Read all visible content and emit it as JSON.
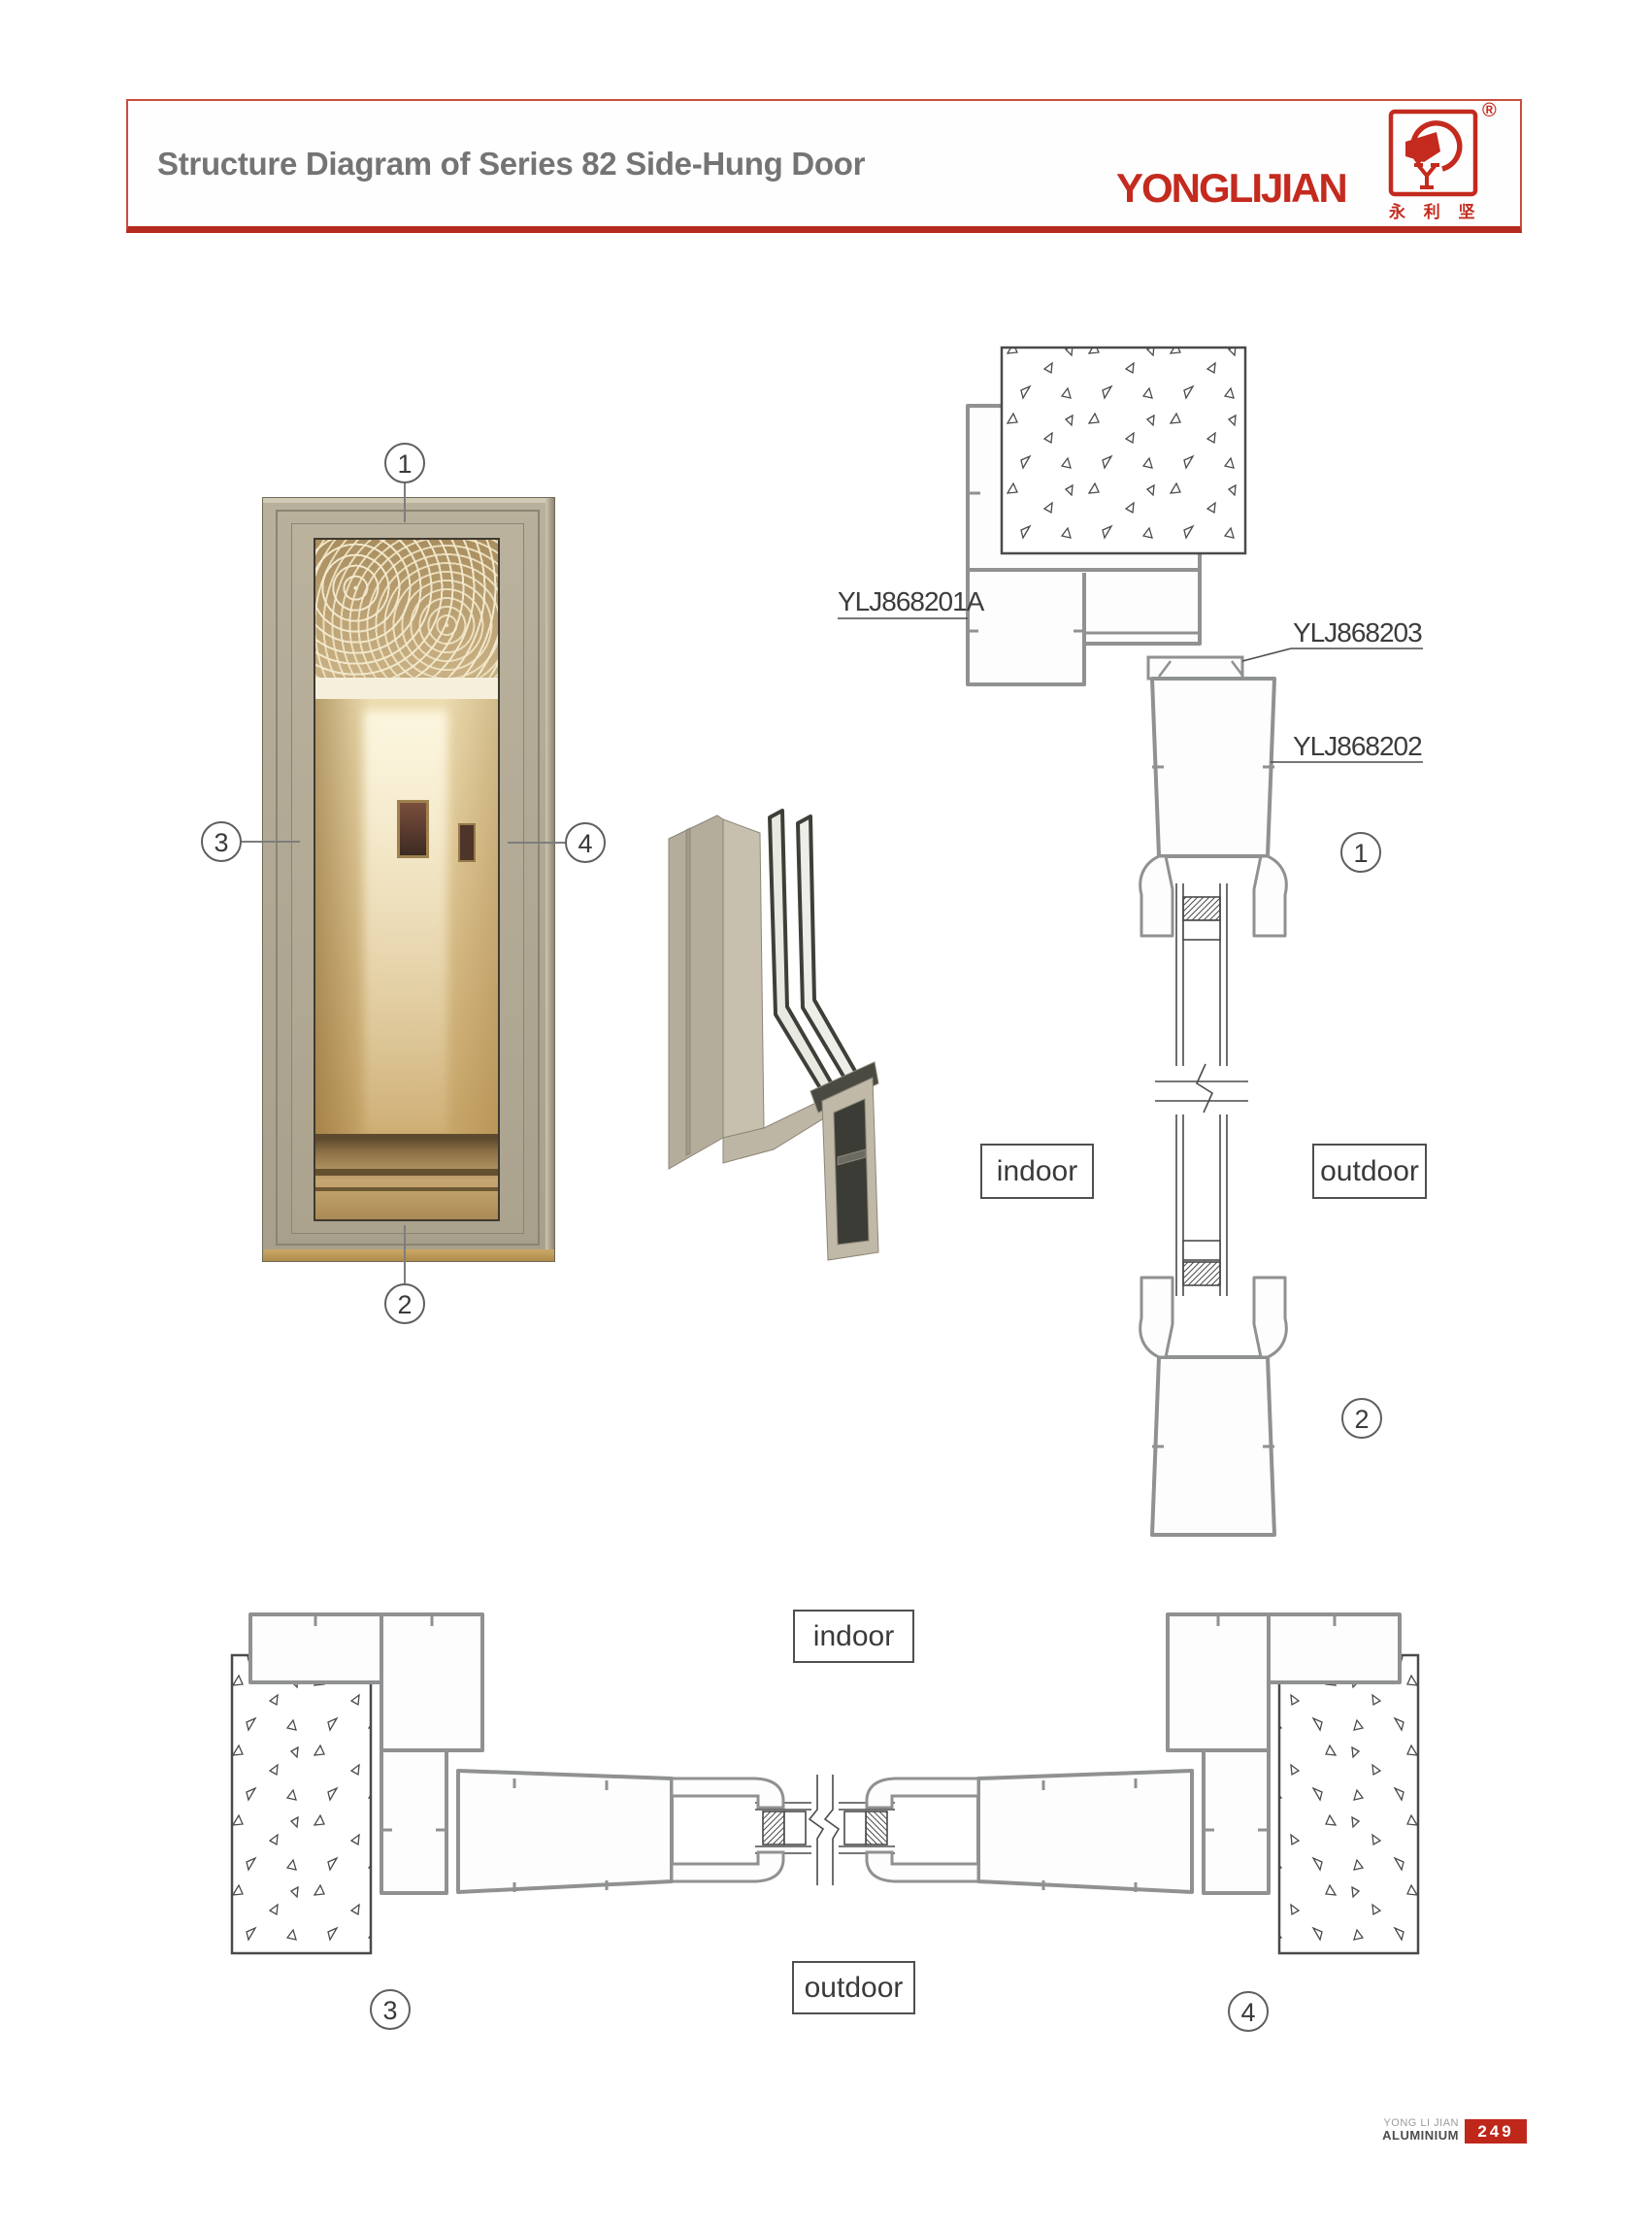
{
  "header": {
    "title": "Structure Diagram of Series 82 Side-Hung Door",
    "brand": "YONGLIJIAN",
    "brand_cn": "永 利 坚",
    "registered_mark": "®"
  },
  "drawing_labels": {
    "frame_profile": "YLJ868201A",
    "bead_profile": "YLJ868203",
    "leaf_profile": "YLJ868202"
  },
  "position_labels": {
    "top_indoor": "indoor",
    "top_outdoor": "outdoor",
    "bottom_indoor": "indoor",
    "bottom_outdoor": "outdoor"
  },
  "callouts": {
    "n1": "1",
    "n2": "2",
    "n3": "3",
    "n4": "4"
  },
  "footer": {
    "company": "YONG LI JIAN",
    "division": "ALUMINIUM",
    "page_number": "249"
  },
  "colors": {
    "accent_red": "#c42a1e",
    "header_border_red": "#c94d3e",
    "header_bottom_red": "#b52a1e",
    "title_gray": "#747474",
    "profile_line_gray": "#8f9192",
    "drawing_dark_line": "#4a4a4a",
    "door_frame_beige": "#b3ab96"
  }
}
